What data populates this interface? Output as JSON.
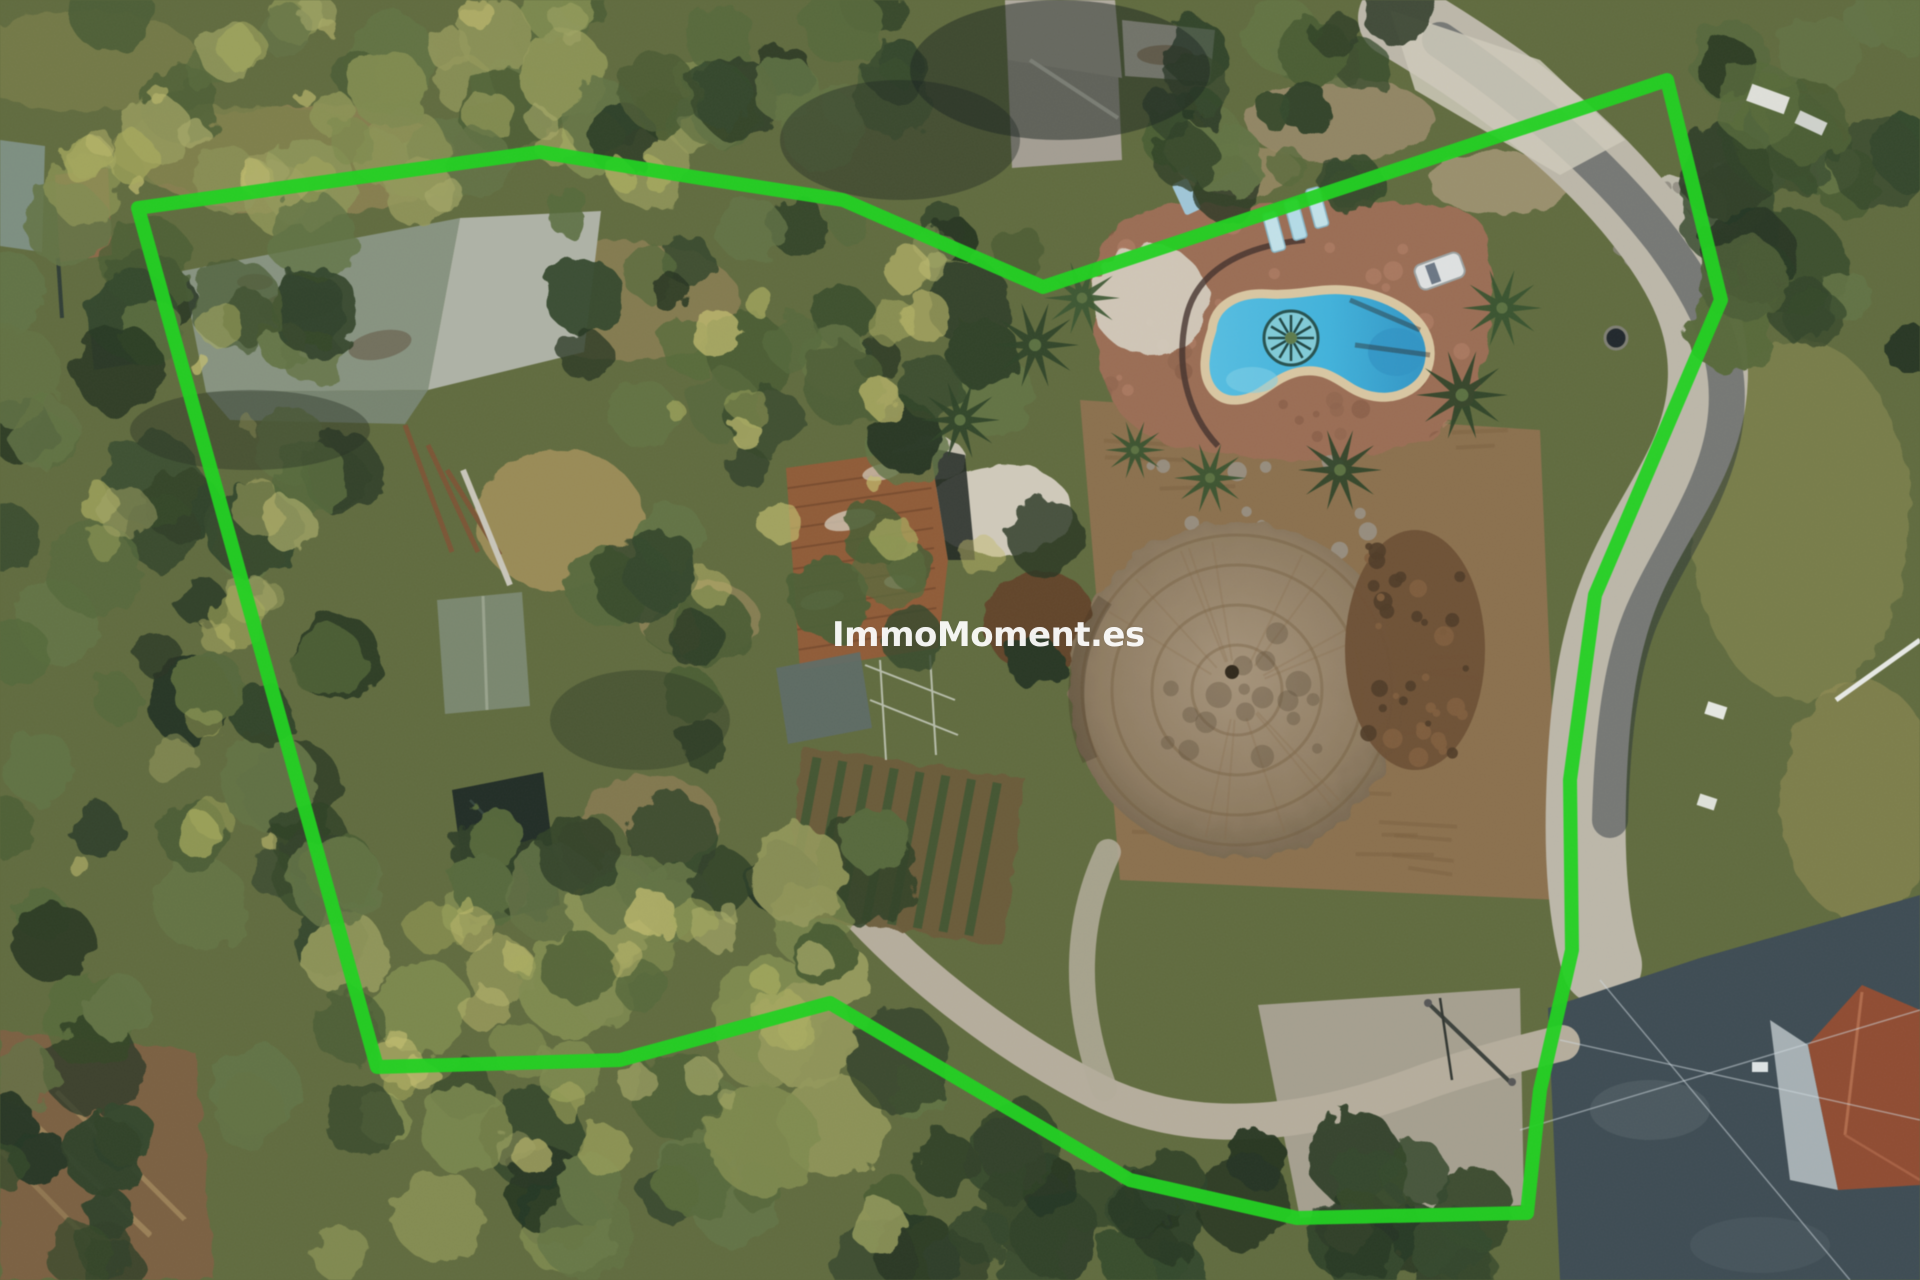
{
  "watermark": {
    "text": "ImmoMoment.es",
    "color": "#ffffff",
    "opacity": 0.58
  },
  "boundary": {
    "points": "138,208 540,152 700,178 843,200 1043,287 1667,80 1721,300 1595,595 1570,780 1572,950 1540,1090 1527,1213 1297,1218 1130,1180 830,1003 620,1060 377,1067",
    "color": "#1dd11d",
    "stroke_width": 14
  },
  "scene": {
    "colors": {
      "base_ground": "#5f6a3d",
      "tree_dark": "#2e3f26",
      "tree_mid": "#55683a",
      "tree_light": "#7e8a4e",
      "tree_sunlit": "#a9ac5e",
      "dry_grass": "#a08e58",
      "main_roof": "#86927f",
      "main_roof_light": "#aeb2a6",
      "small_roof": "#79866e",
      "rust_roof": "#8f5a36",
      "cabin_roof": "#1f2b24",
      "top_house_roof": "#a39d92",
      "red_roof": "#8f4a30",
      "terrace": "#9a6c53",
      "pool_water": "#3fb2dc",
      "pool_deep": "#2f93c4",
      "pool_coping": "#d9c7a2",
      "sun_mosaic": "#5ec0b4",
      "mound": "#8d7a60",
      "mound_center": "#a5937a",
      "rubble_brown": "#6b4e33",
      "field_brown": "#8a6f4c",
      "road_gravel": "#bcb7a9",
      "asphalt": "#3c4a52",
      "driveway": "#b5ad9c",
      "soil_bottom_left": "#7a5f3f",
      "white_patch": "#d6d0c2"
    }
  }
}
